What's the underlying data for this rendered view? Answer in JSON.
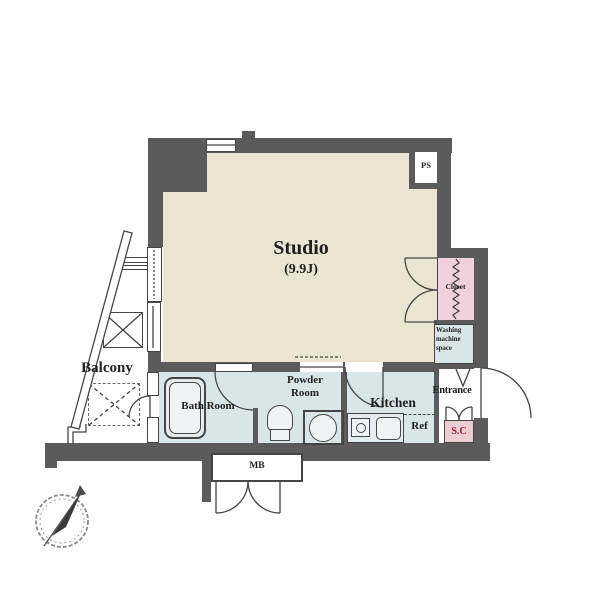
{
  "rooms": {
    "studio": {
      "label": "Studio",
      "size": "(9.9J)"
    },
    "balcony": {
      "label": "Balcony"
    },
    "bath": {
      "label": "Bath Room"
    },
    "powder": {
      "line1": "Powder",
      "line2": "Room"
    },
    "kitchen": {
      "label": "Kitchen"
    },
    "entrance": {
      "label": "Entrance"
    },
    "closet": {
      "label": "Closet"
    },
    "washing": {
      "line1": "Washing",
      "line2": "machine",
      "line3": "space"
    },
    "shoe_closet": {
      "label": "S.C"
    },
    "meter_box": {
      "label": "MB"
    },
    "pipe_space": {
      "label": "PS"
    },
    "refrigerator": {
      "label": "Ref"
    }
  },
  "colors": {
    "wall": "#5b5b5b",
    "line": "#454545",
    "beige": "#ece4d2",
    "wet": "#d8e6e8",
    "pink": "#f0d0da",
    "scpink": "#eecdd2",
    "sctext": "#8c232e",
    "ink": "#1f1f1f"
  }
}
